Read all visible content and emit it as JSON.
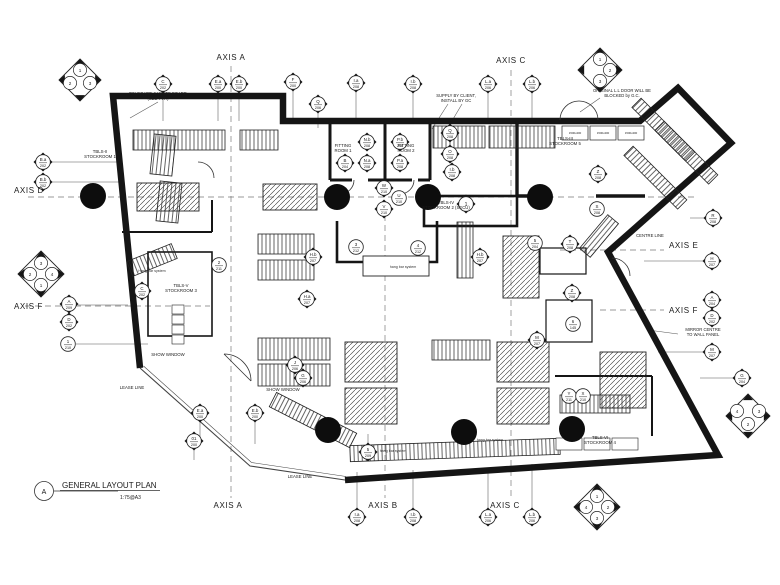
{
  "colors": {
    "ink": "#151515",
    "paper": "#ffffff",
    "dash": "#7a7a7a",
    "thin": "#555555"
  },
  "title_block": {
    "detail_letter": "A",
    "title": "GENERAL LAYOUT PLAN",
    "scale": "1:75@A3"
  },
  "axis_labels": [
    {
      "id": "axis-a-top",
      "text": "AXIS A"
    },
    {
      "id": "axis-c-top",
      "text": "AXIS C"
    },
    {
      "id": "axis-d-left",
      "text": "AXIS D"
    },
    {
      "id": "axis-f-left",
      "text": "AXIS F"
    },
    {
      "id": "axis-e-right",
      "text": "AXIS E"
    },
    {
      "id": "axis-f-right",
      "text": "AXIS F"
    },
    {
      "id": "axis-a-bottom",
      "text": "AXIS A"
    },
    {
      "id": "axis-b-bottom",
      "text": "AXIS B"
    },
    {
      "id": "axis-c-bottom",
      "text": "AXIS C"
    }
  ],
  "rooms": [
    {
      "id": "sr1",
      "lines": [
        "TBLS-II",
        "STOCKROOM 1"
      ]
    },
    {
      "id": "sr2",
      "lines": [
        "TBLS-IV",
        "STOCKROOM 2 (SECU)"
      ]
    },
    {
      "id": "sr3",
      "lines": [
        "TBLS-V",
        "STOCKROOM 3"
      ]
    },
    {
      "id": "sr4",
      "lines": [
        "TBLS-VI",
        "STOCKROOM 4"
      ]
    },
    {
      "id": "sr5",
      "lines": [
        "TBLS-III",
        "STOCKROOM 5"
      ]
    },
    {
      "id": "fitting1",
      "lines": [
        "FITTING",
        "ROOM 1"
      ]
    },
    {
      "id": "fitting2",
      "lines": [
        "FITTING",
        "ROOM 2"
      ]
    },
    {
      "id": "show1",
      "lines": [
        "SHOW WINDOW"
      ]
    },
    {
      "id": "show2",
      "lines": [
        "SHOW WINDOW"
      ]
    },
    {
      "id": "lease1",
      "lines": [
        "LEASE LINE"
      ]
    },
    {
      "id": "lease2",
      "lines": [
        "LEASE LINE"
      ]
    }
  ],
  "annotations": [
    {
      "id": "pinboard",
      "lines": [
        "PIN BOARD & WHITE BOARD",
        "(SEE TYP.)"
      ]
    },
    {
      "id": "supply",
      "lines": [
        "SUPPLY BY CLIENT,",
        "INSTALL BY GC"
      ]
    },
    {
      "id": "origdoor",
      "lines": [
        "ORIGINAL L.L DOOR WILL BE",
        "BLOCKED by G.C."
      ]
    },
    {
      "id": "mirror",
      "lines": [
        "MIRROR CENTRE",
        "TO WALL PANEL"
      ]
    },
    {
      "id": "centreline",
      "lines": [
        "CENTRE LINE"
      ]
    },
    {
      "id": "hang1",
      "lines": [
        "Hang bar system"
      ]
    },
    {
      "id": "hang2",
      "lines": [
        "hang bar system"
      ]
    },
    {
      "id": "hang3",
      "lines": [
        "hang bar system"
      ]
    },
    {
      "id": "hang4",
      "lines": [
        "hang bar system"
      ]
    }
  ],
  "shelf_label": "1500x400",
  "markers": [
    {
      "id": "c202",
      "kind": "d",
      "label": "C",
      "num": "202"
    },
    {
      "id": "ea200t",
      "kind": "d",
      "label": "E.a",
      "num": "200"
    },
    {
      "id": "eb200t",
      "kind": "d",
      "label": "E.b",
      "num": "200"
    },
    {
      "id": "f200",
      "kind": "d",
      "label": "F",
      "num": "200"
    },
    {
      "id": "q206",
      "kind": "d",
      "label": "Q",
      "num": "206"
    },
    {
      "id": "ia208t",
      "kind": "d",
      "label": "I.a",
      "num": "208"
    },
    {
      "id": "ib208t",
      "kind": "d",
      "label": "I.b",
      "num": "208"
    },
    {
      "id": "la206t",
      "kind": "d",
      "label": "L.a",
      "num": "206"
    },
    {
      "id": "lb206t",
      "kind": "d",
      "label": "L.b",
      "num": "206"
    },
    {
      "id": "r208",
      "kind": "d",
      "label": "R",
      "num": "208"
    },
    {
      "id": "h207",
      "kind": "d",
      "label": "H",
      "num": "207"
    },
    {
      "id": "a204r",
      "kind": "d",
      "label": "A",
      "num": "204"
    },
    {
      "id": "d202r",
      "kind": "d",
      "label": "D",
      "num": "202"
    },
    {
      "id": "m207r",
      "kind": "d",
      "label": "M",
      "num": "207"
    },
    {
      "id": "g204",
      "kind": "d",
      "label": "G",
      "num": "204"
    },
    {
      "id": "ea200b",
      "kind": "d",
      "label": "E.a",
      "num": "200"
    },
    {
      "id": "eb200b",
      "kind": "d",
      "label": "E.b",
      "num": "200"
    },
    {
      "id": "o1200",
      "kind": "d",
      "label": "01",
      "num": "200"
    },
    {
      "id": "five209",
      "kind": "d",
      "label": "5",
      "num": "209"
    },
    {
      "id": "ia208b",
      "kind": "d",
      "label": "I.a",
      "num": "208"
    },
    {
      "id": "ib208b",
      "kind": "d",
      "label": "I.b",
      "num": "208"
    },
    {
      "id": "la206b",
      "kind": "d",
      "label": "L.a",
      "num": "206"
    },
    {
      "id": "lb206b",
      "kind": "d",
      "label": "L.b",
      "num": "206"
    },
    {
      "id": "ba202",
      "kind": "d",
      "label": "B.a",
      "num": "202"
    },
    {
      "id": "bb202",
      "kind": "d",
      "label": "B.b",
      "num": "202"
    },
    {
      "id": "a209",
      "kind": "d",
      "label": "A",
      "num": "209"
    },
    {
      "id": "d202l",
      "kind": "d",
      "label": "D",
      "num": "202"
    },
    {
      "id": "one210",
      "kind": "c",
      "label": "1",
      "num": "210"
    },
    {
      "id": "w210",
      "kind": "d",
      "label": "W",
      "num": "210"
    },
    {
      "id": "u210",
      "kind": "c",
      "label": "U",
      "num": "210"
    },
    {
      "id": "v210",
      "kind": "d",
      "label": "V",
      "num": "210"
    },
    {
      "id": "three212",
      "kind": "c",
      "label": "3",
      "num": "212"
    },
    {
      "id": "four212",
      "kind": "c",
      "label": "4",
      "num": "212"
    },
    {
      "id": "two211",
      "kind": "c",
      "label": "2",
      "num": "211"
    },
    {
      "id": "c202i",
      "kind": "d",
      "label": "C",
      "num": "202"
    },
    {
      "id": "hb207a",
      "kind": "d",
      "label": "H.b",
      "num": "207"
    },
    {
      "id": "ha207",
      "kind": "d",
      "label": "H.a",
      "num": "207"
    },
    {
      "id": "hb207b",
      "kind": "d",
      "label": "H.b",
      "num": "207"
    },
    {
      "id": "j206",
      "kind": "d",
      "label": "J",
      "num": "206"
    },
    {
      "id": "g206",
      "kind": "d",
      "label": "G",
      "num": "206"
    },
    {
      "id": "five204",
      "kind": "c",
      "label": "5",
      "num": "204"
    },
    {
      "id": "t208",
      "kind": "d",
      "label": "T",
      "num": "208"
    },
    {
      "id": "z208a",
      "kind": "d",
      "label": "Z",
      "num": "208"
    },
    {
      "id": "six145",
      "kind": "c",
      "label": "6",
      "num": "145"
    },
    {
      "id": "m207i",
      "kind": "d",
      "label": "M",
      "num": "207"
    },
    {
      "id": "s208",
      "kind": "c",
      "label": "S",
      "num": "208"
    },
    {
      "id": "z208b",
      "kind": "d",
      "label": "Z",
      "num": "208"
    },
    {
      "id": "y211",
      "kind": "c",
      "label": "Y",
      "num": "211"
    },
    {
      "id": "x210",
      "kind": "c",
      "label": "X",
      "num": "210"
    },
    {
      "id": "q208c",
      "kind": "d",
      "label": "Q",
      "num": "208"
    },
    {
      "id": "o208",
      "kind": "d",
      "label": "O",
      "num": "208"
    },
    {
      "id": "ib208c",
      "kind": "d",
      "label": "I.b",
      "num": "208"
    },
    {
      "id": "nb208",
      "kind": "d",
      "label": "N.b",
      "num": "208"
    },
    {
      "id": "na208",
      "kind": "d",
      "label": "N.a",
      "num": "208"
    },
    {
      "id": "b204",
      "kind": "d",
      "label": "B",
      "num": "204"
    },
    {
      "id": "pb208",
      "kind": "d",
      "label": "P.b",
      "num": "208"
    },
    {
      "id": "pa208",
      "kind": "d",
      "label": "P.a",
      "num": "208"
    },
    {
      "id": "sr2one",
      "kind": "d",
      "label": "1",
      "num": ""
    }
  ],
  "clusters": [
    {
      "id": "tl",
      "items": [
        {
          "label": "1"
        },
        {
          "label": "2"
        },
        {
          "label": "3"
        }
      ]
    },
    {
      "id": "tr",
      "items": [
        {
          "label": "1"
        },
        {
          "label": "2"
        },
        {
          "label": "3"
        }
      ]
    },
    {
      "id": "left",
      "items": [
        {
          "label": "3"
        },
        {
          "label": "2"
        },
        {
          "label": "4"
        },
        {
          "label": "1"
        }
      ]
    },
    {
      "id": "br",
      "items": [
        {
          "label": "1"
        },
        {
          "label": "4"
        },
        {
          "label": "2"
        },
        {
          "label": "3"
        }
      ]
    },
    {
      "id": "fr",
      "items": [
        {
          "label": "4"
        },
        {
          "label": "3"
        },
        {
          "label": "2"
        }
      ]
    }
  ]
}
